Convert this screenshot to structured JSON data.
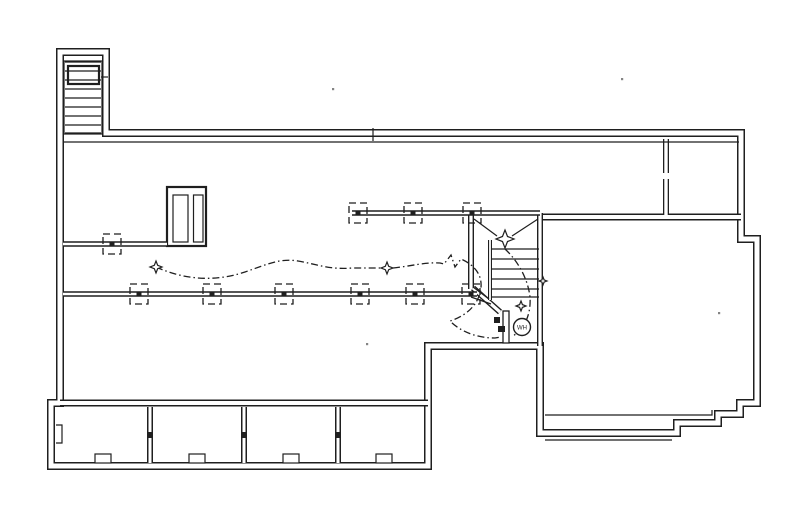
{
  "drawing": {
    "kind": "basement-foundation-floor-plan",
    "background": "#ffffff",
    "ink": "#1f1f1f",
    "labels": {
      "water_heater": "WH"
    },
    "beams": [
      {
        "name": "upper-left-beam",
        "y": 244,
        "x1": 63,
        "x2": 167,
        "piers": [
          112
        ]
      },
      {
        "name": "lower-main-beam",
        "y": 294,
        "x1": 63,
        "x2": 477,
        "piers": [
          139,
          212,
          284,
          360,
          415,
          471
        ]
      },
      {
        "name": "upper-main-beam",
        "y": 213,
        "x1": 352,
        "x2": 540,
        "piers": [
          358,
          413,
          472
        ]
      }
    ],
    "pier_box": {
      "w": 18,
      "h": 20,
      "center_mark": 5
    },
    "porch": {
      "piers_x": [
        150,
        244,
        338
      ],
      "pier_y1": 407,
      "pier_y2": 463,
      "pier_mark": 6,
      "vents_x": [
        103,
        197,
        291,
        384
      ],
      "vent_w": 16,
      "vent_h": 9,
      "vent_y": 454
    },
    "bulkhead_treads_y": [
      62,
      71,
      80,
      89,
      98,
      107,
      116,
      125,
      133
    ],
    "bulkhead_tread_x1": 65,
    "bulkhead_tread_x2": 101,
    "stair_treads_y": [
      249,
      259,
      269,
      279,
      289,
      297
    ],
    "stair_tread_x1": 492,
    "stair_tread_x2": 539,
    "light_fixtures": [
      {
        "x": 156,
        "y": 267,
        "r": 6
      },
      {
        "x": 387,
        "y": 268,
        "r": 6
      },
      {
        "x": 505,
        "y": 239,
        "r": 9
      },
      {
        "x": 521,
        "y": 306,
        "r": 5
      },
      {
        "x": 543,
        "y": 281,
        "r": 4
      }
    ],
    "specks": [
      [
        332,
        88
      ],
      [
        621,
        78
      ],
      [
        718,
        312
      ],
      [
        366,
        343
      ]
    ]
  }
}
